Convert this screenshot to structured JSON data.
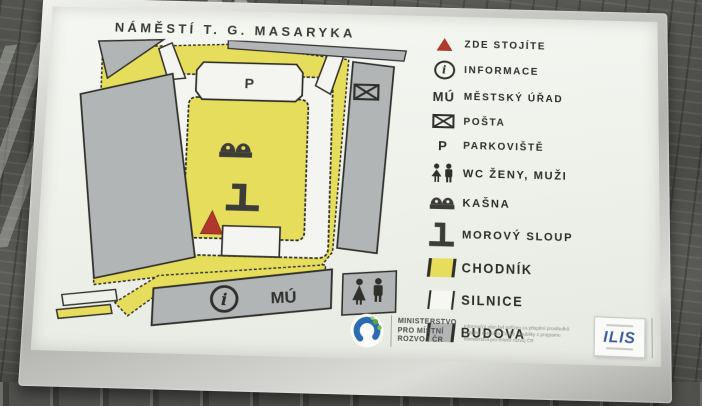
{
  "sign": {
    "title": "NÁMĚSTÍ T. G. MASARYKA",
    "map": {
      "parking_label": "P",
      "town_hall_label": "MÚ",
      "info_label": "i"
    },
    "legend": {
      "items": [
        {
          "icon": "you-are-here-triangle",
          "label": "ZDE STOJÍTE"
        },
        {
          "icon": "information-circle",
          "symbol": "i",
          "label": "INFORMACE"
        },
        {
          "icon": "mu-letters",
          "symbol": "MÚ",
          "label": "MĚSTSKÝ ÚŘAD"
        },
        {
          "icon": "envelope",
          "label": "POŠTA"
        },
        {
          "icon": "p-letter",
          "symbol": "P",
          "label": "PARKOVIŠTĚ"
        },
        {
          "icon": "wc-figures",
          "label": "WC ŽENY, MUŽI"
        },
        {
          "icon": "fountain",
          "label": "KAŠNA"
        },
        {
          "icon": "plague-column",
          "label": "MOROVÝ SLOUP"
        },
        {
          "icon": "swatch-yellow",
          "label": "CHODNÍK",
          "color": "#e5dd5b"
        },
        {
          "icon": "swatch-white",
          "label": "SILNICE",
          "color": "#f6f7f2"
        },
        {
          "icon": "swatch-gray",
          "label": "BUDOVA",
          "color": "#b2b5b6"
        }
      ]
    },
    "footer": {
      "ministry_line1": "MINISTERSTVO",
      "ministry_line2": "PRO MÍSTNÍ",
      "ministry_line3": "ROZVOJ ČR",
      "funding_note": "Informační plán byl pořízen za přispění prostředků státního rozpočtu České republiky z programu Ministerstva pro místní rozvoj ČR",
      "ilis_label": "ILIS"
    },
    "colors": {
      "sidewalk_yellow": "#e5dd5b",
      "building_gray": "#b2b5b6",
      "road_white": "#f4f5f0",
      "outline_dark": "#2f2f2b",
      "marker_red": "#b0372b",
      "ministry_blue": "#2b6bb3",
      "ministry_green": "#5aa43e",
      "ilis_blue": "#3a57a0"
    }
  }
}
